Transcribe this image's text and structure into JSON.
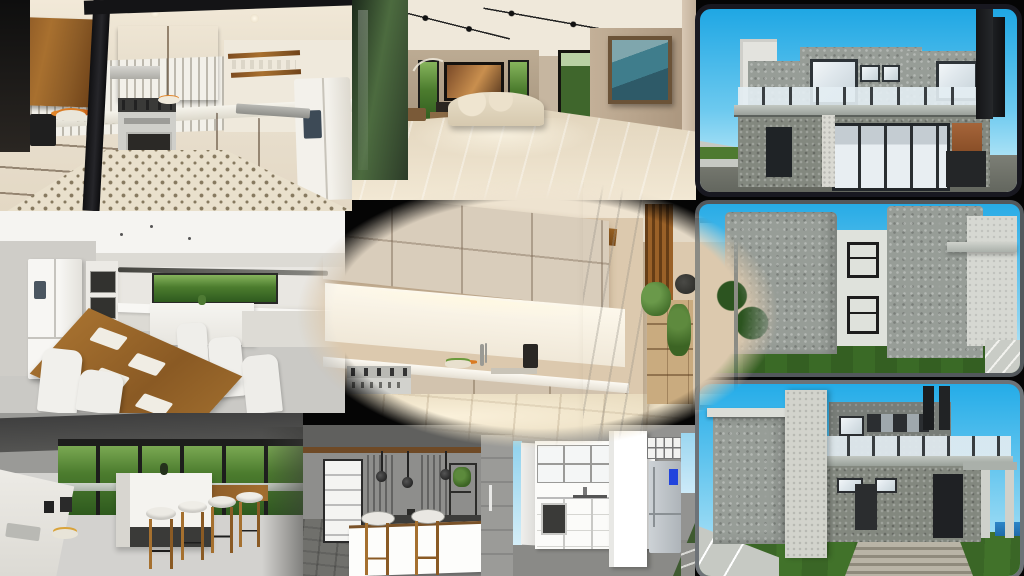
{
  "app": {
    "title": "interior-and-exterior-3d-render-collage"
  },
  "tiles": {
    "kitchen_wood": {
      "label": "wood-kitchen-render",
      "description": "3D render of an L-shaped kitchen with warm wood cabinets, white vertical tile backsplash, stainless gas range, white fridge, patterned cement-tile floor and a black structural beam"
    },
    "kitchen_dining": {
      "label": "white-kitchen-dining-render",
      "description": "3D render of a modern white kitchen with stacked wall ovens, white french-door fridge, long horizontal garden window and a wooden dining table with white chairs"
    },
    "kitchen_island": {
      "label": "island-kitchen-render",
      "description": "3D render of an open kitchen with white island, four wooden-leg bar stools, dark ceiling and full-height glazing onto a green garden with pool"
    },
    "living_room": {
      "label": "living-room-render",
      "description": "3D render of a large beige living room with track lighting, wall TV over a fireplace, cream curved sofa, framed seascape painting and marble floor"
    },
    "kitchen_vignette": {
      "label": "beige-kitchen-vignette-render",
      "description": "Oval vignette 3D render of a warm beige kitchen with cream cabinets, wood trim, stainless range, marble pillar, wood slat wall, crate shelf with plants and a glass door to the garden"
    },
    "sketch_bar": {
      "label": "sketch-bar-kitchen-render",
      "description": "SketchUp style render of a kitchen bar with white counter, two wooden bar stools, three pendant lamps, white panel door and walnut wall panels on grey walls"
    },
    "sketch_white": {
      "label": "sketch-white-kitchen-render",
      "description": "SketchUp style elevation of a white kitchen with glazed upper cabinets, built-in oven, stainless fridge with blue display and a tall white column"
    },
    "house_front": {
      "label": "house-front-elevation-render",
      "description": "SketchUp render of a two-storey stone-clad modern house front with glass balcony railing, large sliding glass doors and tall black chimney under a blue sky"
    },
    "house_side": {
      "label": "house-side-elevation-render",
      "description": "SketchUp render of the side elevation of a grey textured house with two stacked windows, white infill wall, lawn and driveway under a blue sky"
    },
    "house_perspective": {
      "label": "house-perspective-render",
      "description": "SketchUp perspective render of a modern stone house with tall entry pillar, glass balcony, twin chimneys, pergola, entry steps, lawn and pool corner under a blue sky"
    }
  },
  "palette": {
    "sky_blue_top": "#1fa7e4",
    "sky_blue_light": "#b5e6f7",
    "frame_dark": "#181820",
    "frame_grey": "#565b5f",
    "frame_grey_light": "#6d7277",
    "cabinet_wood": "#9a6130",
    "trim_wood": "#8f5a1f",
    "cream_cabinet": "#d9cdbb",
    "beige_wall": "#c6b6a0",
    "warm_floor": "#e9dcc0",
    "marble_floor": "#eadfcb",
    "grey_wall": "#8e8e8c",
    "white_cabinet": "#f4f3ef",
    "lawn_green": "#41722a",
    "tree_green": "#3e7029",
    "stone_grey": "#979d97",
    "black_beam": "#1c1c1e",
    "steel": "#c9c9c6",
    "fridge_blue_display": "#2244dd"
  }
}
